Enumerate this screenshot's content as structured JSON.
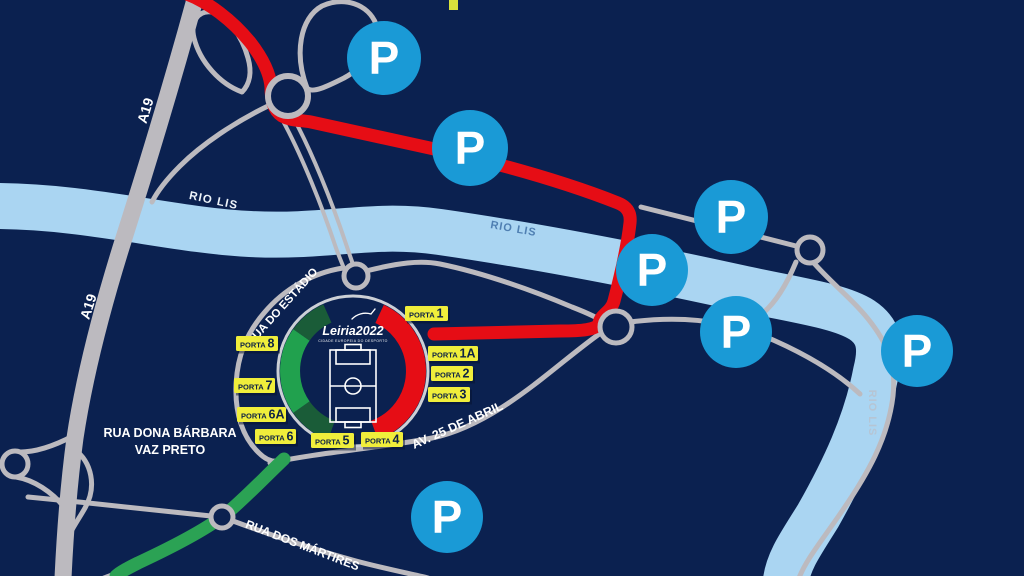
{
  "map": {
    "colors": {
      "background": "#0b2150",
      "river": "#aad5f2",
      "road": "#bcbabf",
      "road_outline": "#ccd0d6",
      "route_red": "#e60d15",
      "route_green": "#2ba254",
      "ring_green": "#21a14e",
      "ring_dark_green": "#1a5c38",
      "parking_blue": "#1a9ad6",
      "gate_yellow": "#f0ee3b",
      "gate_text": "#0e2345",
      "river_label_steel": "#4f7fb2",
      "river_label_pale": "#b6c5d4"
    },
    "river": {
      "name": "RIO LIS"
    },
    "roads": {
      "a19": "A19",
      "estadio": "RUA DO ESTÁDIO",
      "barbara_line1": "RUA DONA BÁRBARA",
      "barbara_line2": "VAZ PRETO",
      "abril": "AV. 25 DE ABRIL",
      "martires": "RUA DOS MÁRTIRES"
    },
    "stadium": {
      "logo": "Leiria2022",
      "logo_subtitle": "CIDADE EUROPEIA DO DESPORTO"
    },
    "parking": {
      "symbol": "P",
      "markers": [
        {
          "x": 384,
          "y": 58,
          "r": 37
        },
        {
          "x": 470,
          "y": 148,
          "r": 38
        },
        {
          "x": 731,
          "y": 217,
          "r": 37
        },
        {
          "x": 652,
          "y": 270,
          "r": 36
        },
        {
          "x": 736,
          "y": 332,
          "r": 36
        },
        {
          "x": 917,
          "y": 351,
          "r": 36
        },
        {
          "x": 447,
          "y": 517,
          "r": 36
        }
      ]
    },
    "gates": [
      {
        "label": "PORTA",
        "number": "1",
        "x": 405,
        "y": 306,
        "w": 43
      },
      {
        "label": "PORTA",
        "number": "1A",
        "x": 428,
        "y": 346,
        "w": 50
      },
      {
        "label": "PORTA",
        "number": "2",
        "x": 431,
        "y": 366,
        "w": 42
      },
      {
        "label": "PORTA",
        "number": "3",
        "x": 428,
        "y": 387,
        "w": 42
      },
      {
        "label": "PORTA",
        "number": "4",
        "x": 361,
        "y": 432,
        "w": 42
      },
      {
        "label": "PORTA",
        "number": "5",
        "x": 311,
        "y": 433,
        "w": 43
      },
      {
        "label": "PORTA",
        "number": "6",
        "x": 255,
        "y": 429,
        "w": 41
      },
      {
        "label": "PORTA",
        "number": "6A",
        "x": 237,
        "y": 407,
        "w": 49
      },
      {
        "label": "PORTA",
        "number": "7",
        "x": 234,
        "y": 378,
        "w": 41
      },
      {
        "label": "PORTA",
        "number": "8",
        "x": 236,
        "y": 336,
        "w": 42
      }
    ]
  }
}
